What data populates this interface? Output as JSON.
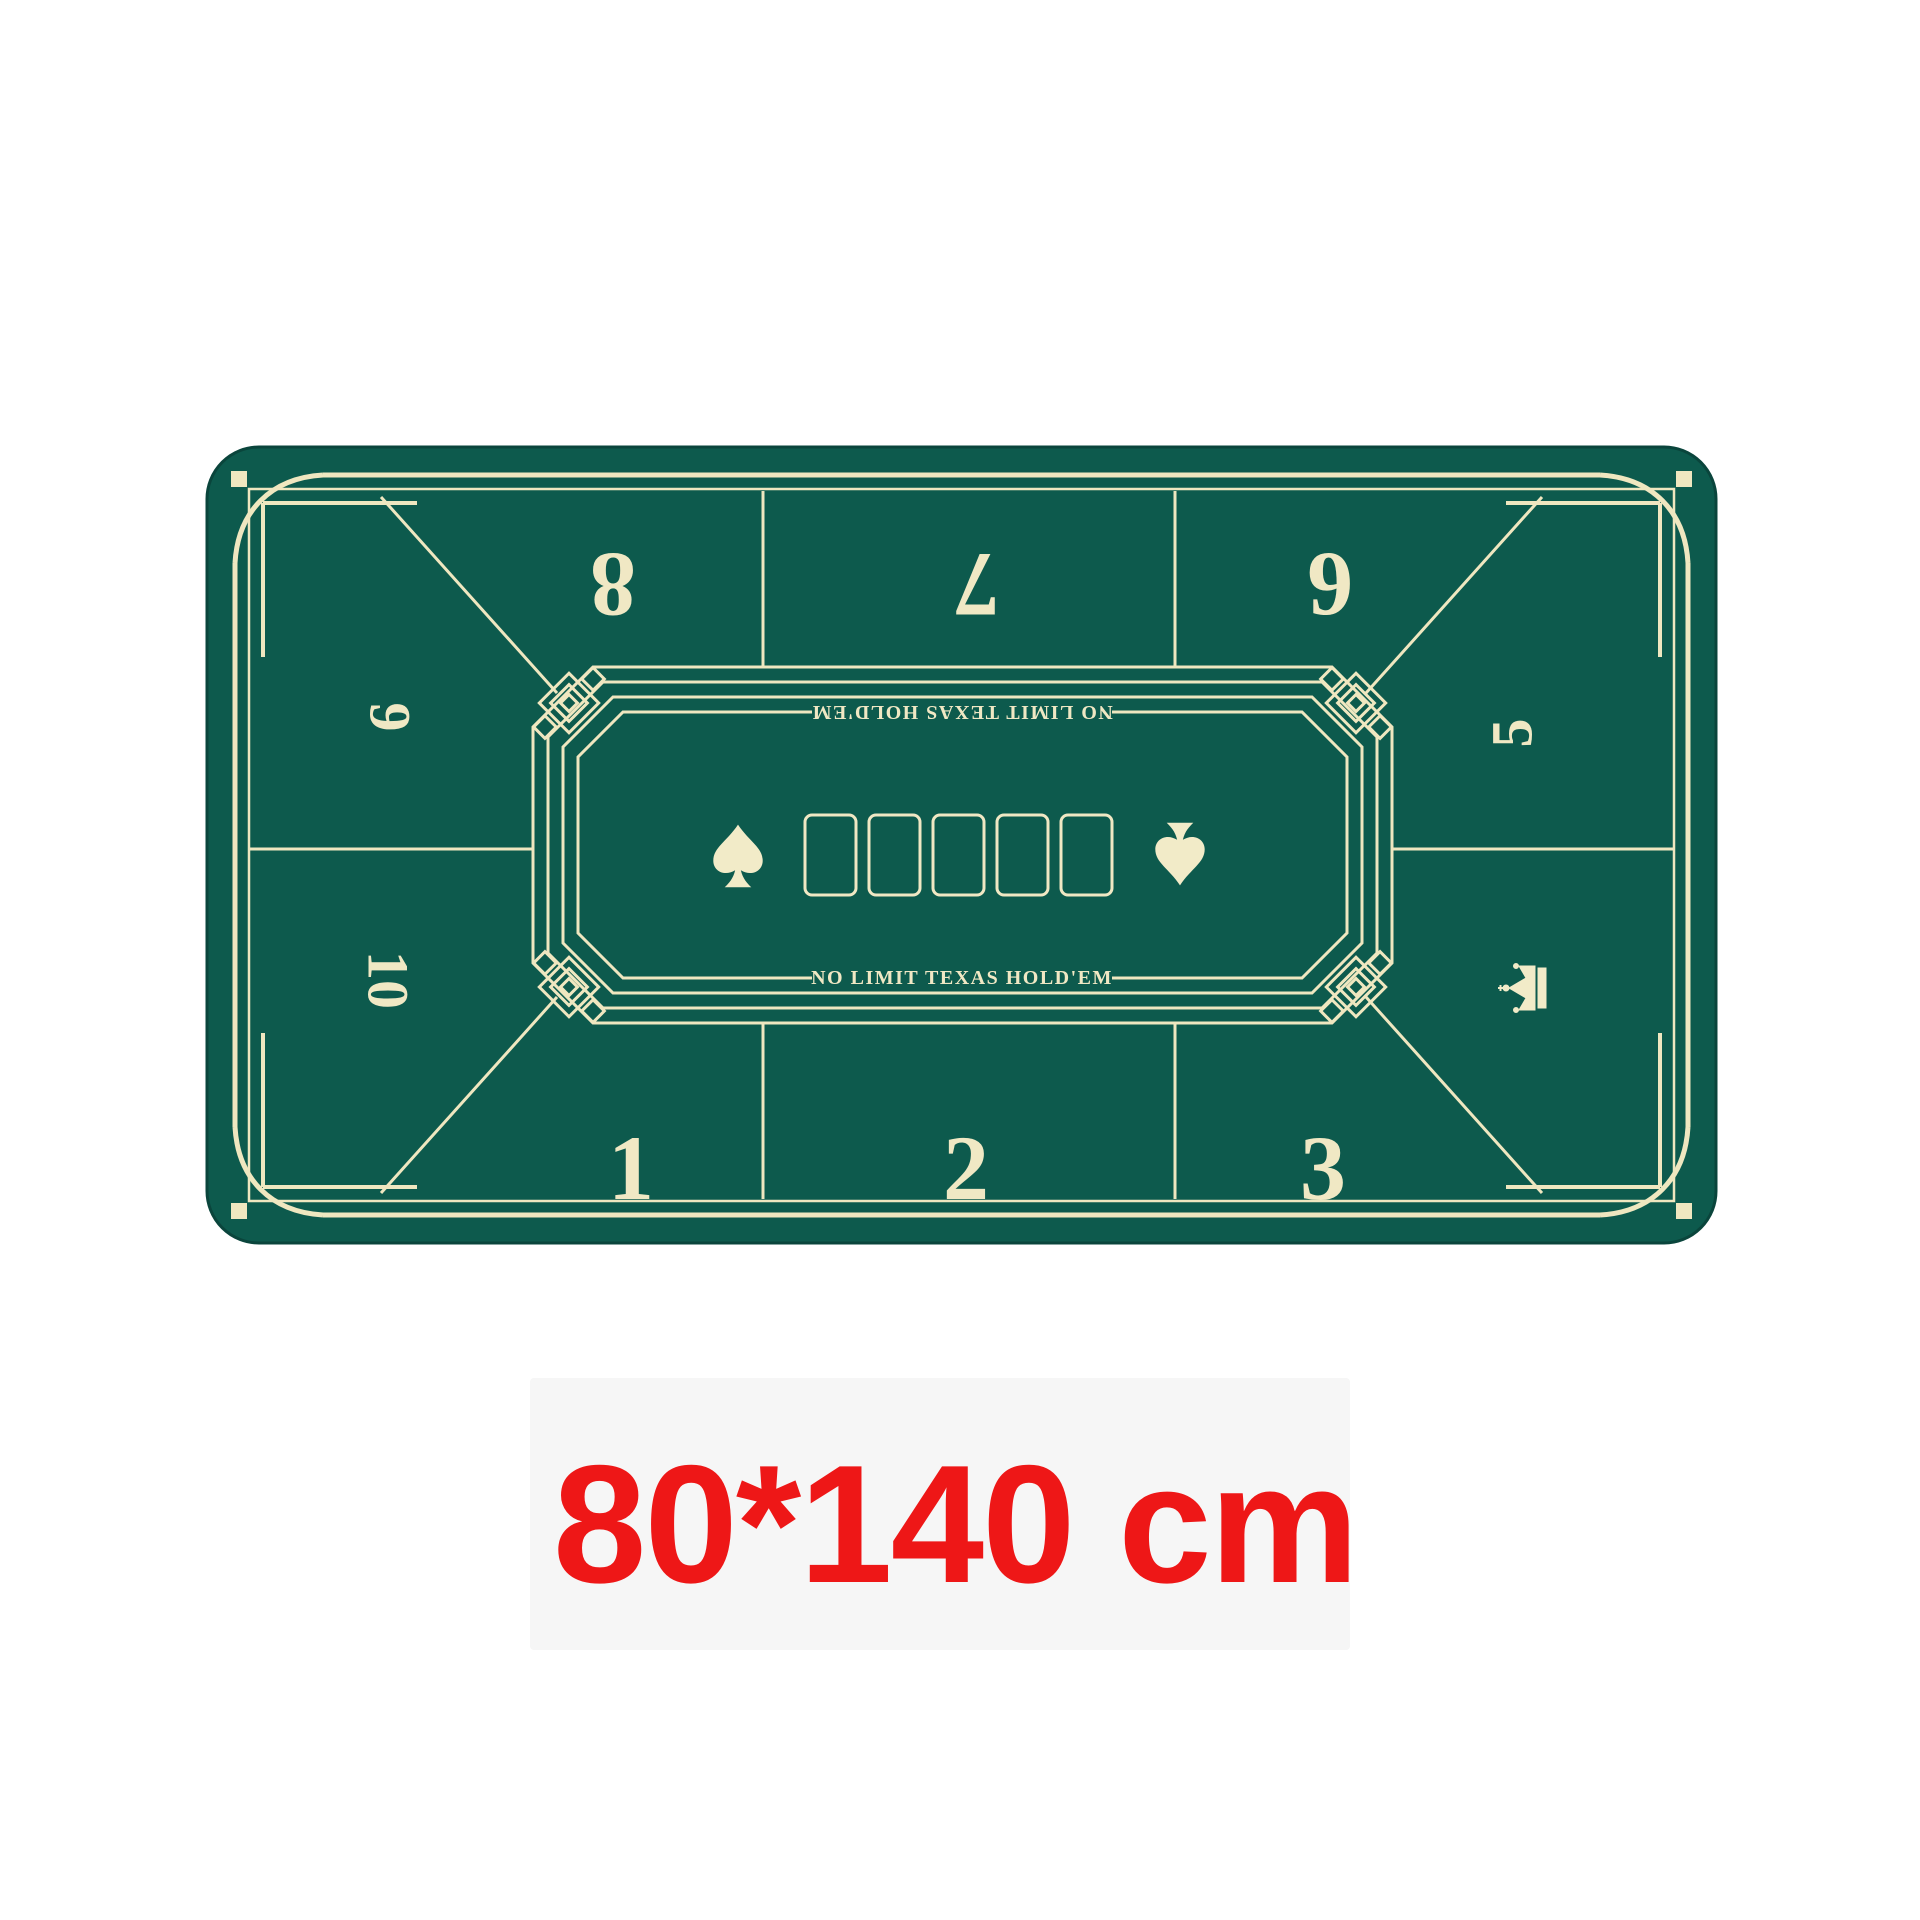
{
  "product": {
    "dimension_label": "80*140 cm",
    "type": "poker-table-mat"
  },
  "mat": {
    "table_text_bottom": "NO LIMIT TEXAS HOLD'EM",
    "table_text_top": "NO LIMIT TEXAS HOLD'EM",
    "seats": {
      "top": [
        "8",
        "7",
        "6"
      ],
      "left": [
        "9",
        "10"
      ],
      "right": [
        "5"
      ],
      "bottom": [
        "1",
        "2",
        "3"
      ]
    },
    "community_card_count": "5",
    "icons": {
      "left_suit": "spade-icon",
      "right_suit": "spade-inverted-icon",
      "brand": "crown-icon"
    },
    "colors": {
      "felt_green": "#0d5a4d",
      "felt_edge": "#0a453c",
      "line_cream": "#efe7c0",
      "glyph_cream": "#f2ebc8",
      "dimension_red": "#ee1717",
      "background": "#ffffff"
    }
  }
}
